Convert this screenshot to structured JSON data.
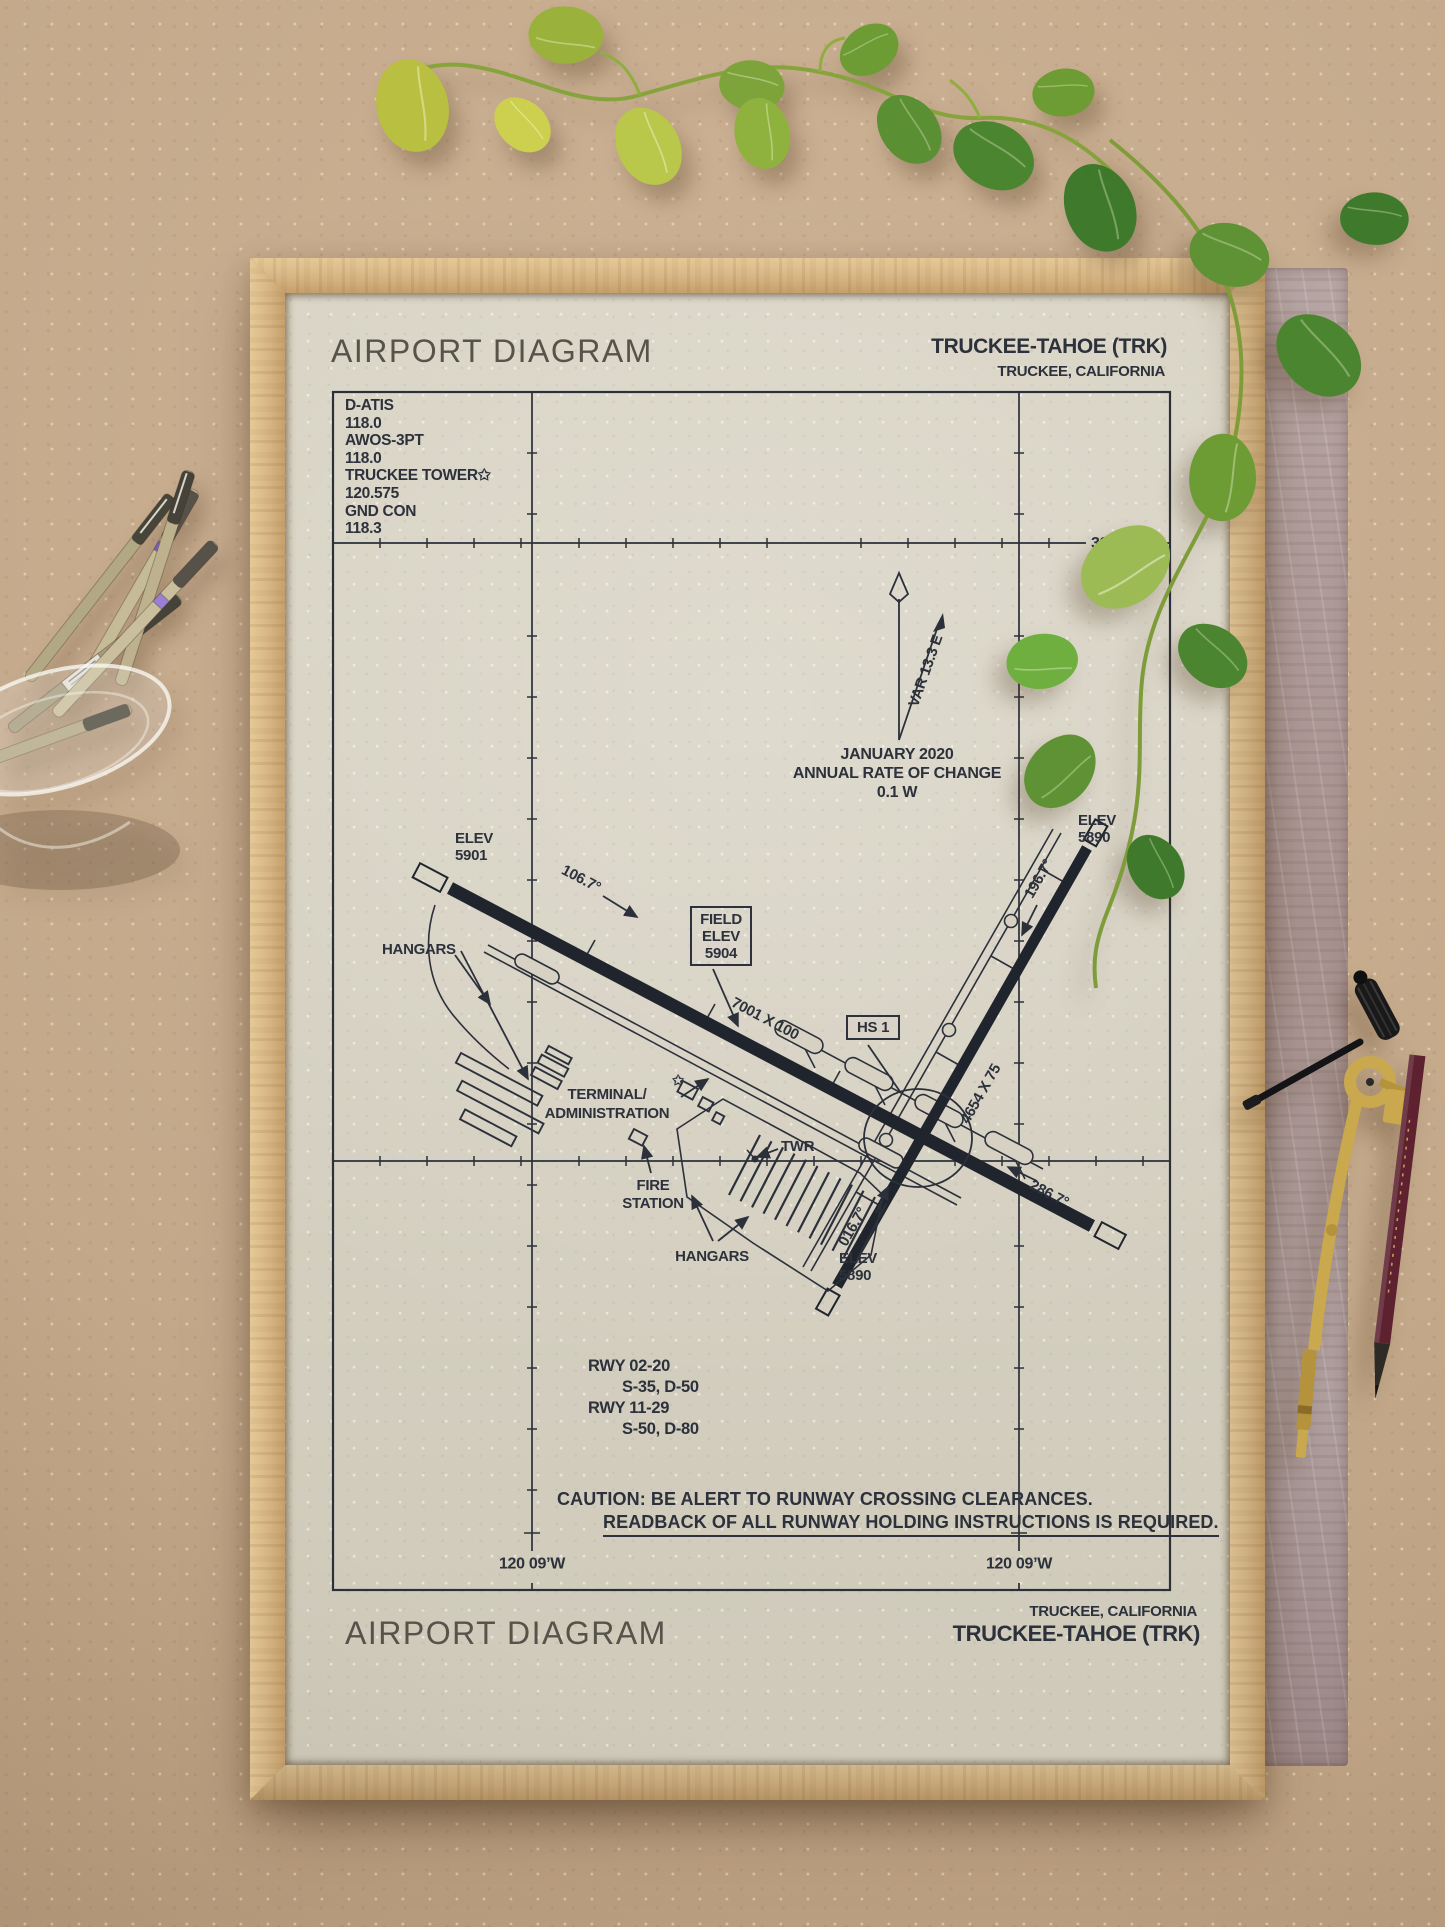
{
  "scene": {
    "board_color": "#c4a98b",
    "frame_color": "#d6b584",
    "paper_color": "#d6d1c2",
    "ink_color": "#2c313b"
  },
  "header": {
    "title": "AIRPORT DIAGRAM",
    "airport": "TRUCKEE-TAHOE (TRK)",
    "location": "TRUCKEE, CALIFORNIA"
  },
  "footer": {
    "title": "AIRPORT DIAGRAM",
    "location": "TRUCKEE, CALIFORNIA",
    "airport": "TRUCKEE-TAHOE (TRK)"
  },
  "comm_box": {
    "lines": [
      "D-ATIS",
      "118.0",
      "AWOS-3PT",
      "118.0",
      "TRUCKEE TOWER✩",
      "120.575",
      "GND CON",
      "118.3"
    ]
  },
  "graticule": {
    "lat_label": "39 19’N",
    "lon_label_left": "120 09’W",
    "lon_label_right": "120 09’W"
  },
  "compass": {
    "variation": "VAR 13.3 E",
    "date": "JANUARY 2020",
    "rate_of_change": "ANNUAL RATE OF CHANGE",
    "rate_value": "0.1 W"
  },
  "airfield": {
    "field_elev": {
      "line1": "FIELD",
      "line2": "ELEV",
      "line3": "5904"
    },
    "rwy11_elev": {
      "line1": "ELEV",
      "line2": "5901"
    },
    "rwy20_elev": {
      "line1": "ELEV",
      "line2": "5890"
    },
    "rwy02_elev": {
      "line1": "ELEV",
      "line2": "5890"
    },
    "hdg_rwy11": "106.7°",
    "hdg_rwy29": "286.7°",
    "hdg_rwy20": "196.7°",
    "hdg_rwy02": "016.7°",
    "dim_rwy_11_29": "7001 X 100",
    "dim_rwy_02_20": "4654 X 75",
    "hotspot": "HS 1",
    "hangars_nw": "HANGARS",
    "hangars_s": "HANGARS",
    "terminal_line1": "TERMINAL/",
    "terminal_line2": "ADMINISTRATION",
    "tower": "TWR",
    "fire_line1": "FIRE",
    "fire_line2": "STATION",
    "beacon": "✩"
  },
  "runway_data": {
    "lines": [
      "RWY 02-20",
      "S-35, D-50",
      "RWY 11-29",
      "S-50, D-80"
    ]
  },
  "caution": {
    "line1": "CAUTION: BE ALERT TO RUNWAY CROSSING CLEARANCES.",
    "line2": "READBACK OF ALL RUNWAY HOLDING INSTRUCTIONS IS REQUIRED."
  }
}
